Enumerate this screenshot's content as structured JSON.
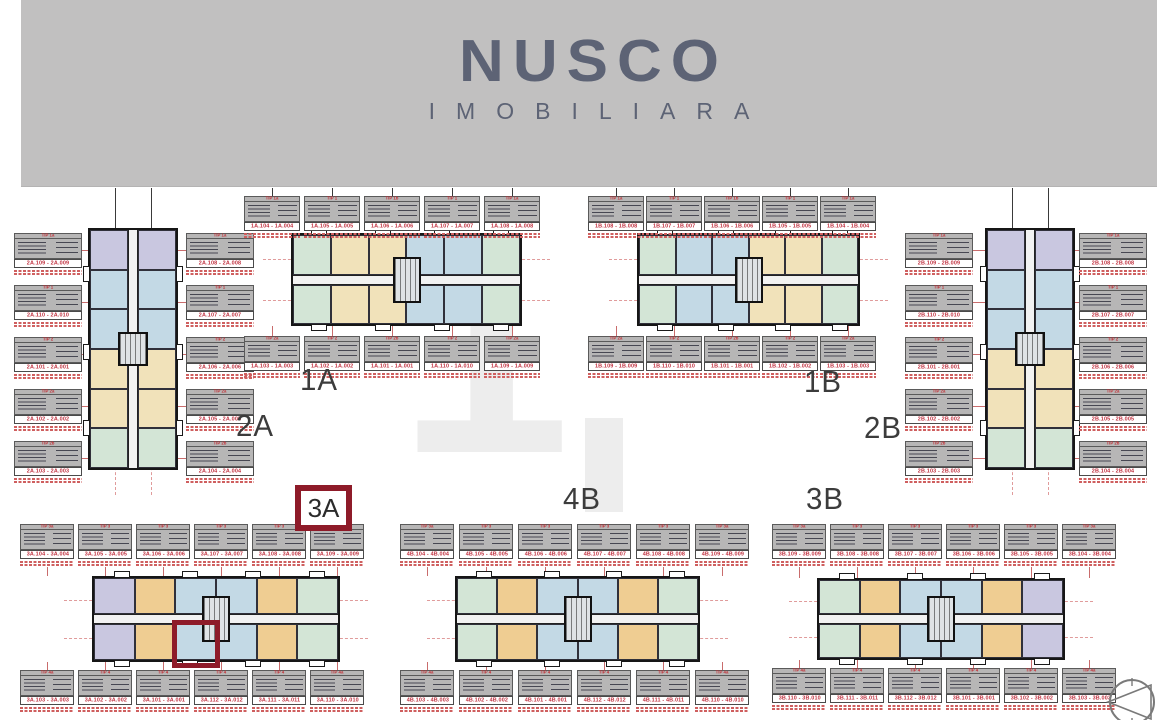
{
  "banner": {
    "logo_title": "NUSCO",
    "logo_subtitle": "IMOBILIARA"
  },
  "highlight": {
    "boxed_label": "3A"
  },
  "palette": {
    "accent_red": "#8e1b29",
    "card_red": "#c0303f",
    "banner_gray": "#c1c0c0",
    "logo_color": "#5d6375",
    "unit_blue": "#c3d9e5",
    "unit_green": "#d3e5d6",
    "unit_cream": "#f1e2ba",
    "unit_orange": "#efcd92",
    "unit_lavender": "#c9c7e0"
  },
  "icons": {
    "compass": "north-compass"
  },
  "buildings": [
    {
      "id": "2A",
      "label": "2A",
      "sections": [
        "lavender",
        "blue",
        "blue",
        "cream",
        "cream",
        "green"
      ],
      "cards_left": [
        {
          "tip": "TIP 1a",
          "range": "2A.109 - 2A.009"
        },
        {
          "tip": "TIP 1",
          "range": "2A.110 - 2A.010"
        },
        {
          "tip": "TIP 2",
          "range": "2A.101 - 2A.001"
        },
        {
          "tip": "TIP 2a",
          "range": "2A.102 - 2A.002"
        },
        {
          "tip": "TIP 2b",
          "range": "2A.103 - 2A.003"
        }
      ],
      "cards_right": [
        {
          "tip": "TIP 1a",
          "range": "2A.108 - 2A.008"
        },
        {
          "tip": "TIP 1",
          "range": "2A.107 - 2A.007"
        },
        {
          "tip": "TIP 2",
          "range": "2A.106 - 2A.006"
        },
        {
          "tip": "TIP 2a",
          "range": "2A.105 - 2A.005"
        },
        {
          "tip": "TIP 2b",
          "range": "2A.104 - 2A.004"
        }
      ]
    },
    {
      "id": "1A",
      "label": "1A",
      "sections": [
        "green",
        "cream",
        "cream",
        "blue",
        "blue",
        "green"
      ],
      "cards_top": [
        {
          "tip": "TIP 1a",
          "range": "1A.104 - 1A.004"
        },
        {
          "tip": "TIP 1",
          "range": "1A.105 - 1A.005"
        },
        {
          "tip": "TIP 1b",
          "range": "1A.106 - 1A.006"
        },
        {
          "tip": "TIP 1",
          "range": "1A.107 - 1A.007"
        },
        {
          "tip": "TIP 1a",
          "range": "1A.108 - 1A.008"
        }
      ],
      "cards_bottom": [
        {
          "tip": "TIP 2a",
          "range": "1A.103 - 1A.003"
        },
        {
          "tip": "TIP 2",
          "range": "1A.102 - 1A.002"
        },
        {
          "tip": "TIP 2b",
          "range": "1A.101 - 1A.001"
        },
        {
          "tip": "TIP 2",
          "range": "1A.110 - 1A.010"
        },
        {
          "tip": "TIP 2a",
          "range": "1A.109 - 1A.009"
        }
      ]
    },
    {
      "id": "1B",
      "label": "1B",
      "sections": [
        "green",
        "blue",
        "blue",
        "cream",
        "cream",
        "green"
      ],
      "cards_top": [
        {
          "tip": "TIP 1a",
          "range": "1B.108 - 1B.008"
        },
        {
          "tip": "TIP 1",
          "range": "1B.107 - 1B.007"
        },
        {
          "tip": "TIP 1b",
          "range": "1B.106 - 1B.006"
        },
        {
          "tip": "TIP 1",
          "range": "1B.105 - 1B.005"
        },
        {
          "tip": "TIP 1a",
          "range": "1B.104 - 1B.004"
        }
      ],
      "cards_bottom": [
        {
          "tip": "TIP 2a",
          "range": "1B.109 - 1B.009"
        },
        {
          "tip": "TIP 2",
          "range": "1B.110 - 1B.010"
        },
        {
          "tip": "TIP 2b",
          "range": "1B.101 - 1B.001"
        },
        {
          "tip": "TIP 2",
          "range": "1B.102 - 1B.002"
        },
        {
          "tip": "TIP 2a",
          "range": "1B.103 - 1B.003"
        }
      ]
    },
    {
      "id": "2B",
      "label": "2B",
      "sections": [
        "lavender",
        "blue",
        "blue",
        "cream",
        "cream",
        "green"
      ],
      "cards_left": [
        {
          "tip": "TIP 1a",
          "range": "2B.109 - 2B.009"
        },
        {
          "tip": "TIP 1",
          "range": "2B.110 - 2B.010"
        },
        {
          "tip": "TIP 2",
          "range": "2B.101 - 2B.001"
        },
        {
          "tip": "TIP 2a",
          "range": "2B.102 - 2B.002"
        },
        {
          "tip": "TIP 2b",
          "range": "2B.103 - 2B.003"
        }
      ],
      "cards_right": [
        {
          "tip": "TIP 1a",
          "range": "2B.108 - 2B.008"
        },
        {
          "tip": "TIP 1",
          "range": "2B.107 - 2B.007"
        },
        {
          "tip": "TIP 2",
          "range": "2B.106 - 2B.006"
        },
        {
          "tip": "TIP 2a",
          "range": "2B.105 - 2B.005"
        },
        {
          "tip": "TIP 2b",
          "range": "2B.104 - 2B.004"
        }
      ]
    },
    {
      "id": "3A",
      "label": "3A",
      "sections": [
        "lavender",
        "orange",
        "blue",
        "blue",
        "orange",
        "green"
      ],
      "cards_top": [
        {
          "tip": "TIP 3a",
          "range": "3A.104 - 3A.004"
        },
        {
          "tip": "TIP 3",
          "range": "3A.105 - 3A.005"
        },
        {
          "tip": "TIP 3",
          "range": "3A.106 - 3A.006"
        },
        {
          "tip": "TIP 3",
          "range": "3A.107 - 3A.007"
        },
        {
          "tip": "TIP 3",
          "range": "3A.108 - 3A.008"
        },
        {
          "tip": "TIP 3a",
          "range": "3A.109 - 3A.009"
        }
      ],
      "cards_bottom": [
        {
          "tip": "TIP 4a",
          "range": "3A.103 - 3A.003"
        },
        {
          "tip": "TIP 4",
          "range": "3A.102 - 3A.002"
        },
        {
          "tip": "TIP 4",
          "range": "3A.101 - 3A.001"
        },
        {
          "tip": "TIP 4",
          "range": "3A.112 - 3A.012"
        },
        {
          "tip": "TIP 4",
          "range": "3A.111 - 3A.011"
        },
        {
          "tip": "TIP 4a",
          "range": "3A.110 - 3A.010"
        }
      ]
    },
    {
      "id": "4B",
      "label": "4B",
      "sections": [
        "green",
        "orange",
        "blue",
        "blue",
        "orange",
        "green"
      ],
      "cards_top": [
        {
          "tip": "TIP 3a",
          "range": "4B.104 - 4B.004"
        },
        {
          "tip": "TIP 3",
          "range": "4B.105 - 4B.005"
        },
        {
          "tip": "TIP 3",
          "range": "4B.106 - 4B.006"
        },
        {
          "tip": "TIP 3",
          "range": "4B.107 - 4B.007"
        },
        {
          "tip": "TIP 3",
          "range": "4B.108 - 4B.008"
        },
        {
          "tip": "TIP 3a",
          "range": "4B.109 - 4B.009"
        }
      ],
      "cards_bottom": [
        {
          "tip": "TIP 4a",
          "range": "4B.103 - 4B.003"
        },
        {
          "tip": "TIP 4",
          "range": "4B.102 - 4B.002"
        },
        {
          "tip": "TIP 4",
          "range": "4B.101 - 4B.001"
        },
        {
          "tip": "TIP 4",
          "range": "4B.112 - 4B.012"
        },
        {
          "tip": "TIP 4",
          "range": "4B.111 - 4B.011"
        },
        {
          "tip": "TIP 4a",
          "range": "4B.110 - 4B.010"
        }
      ]
    },
    {
      "id": "3B",
      "label": "3B",
      "sections": [
        "green",
        "orange",
        "blue",
        "blue",
        "orange",
        "lavender"
      ],
      "cards_top": [
        {
          "tip": "TIP 3a",
          "range": "3B.109 - 3B.009"
        },
        {
          "tip": "TIP 3",
          "range": "3B.108 - 3B.008"
        },
        {
          "tip": "TIP 3",
          "range": "3B.107 - 3B.007"
        },
        {
          "tip": "TIP 3",
          "range": "3B.106 - 3B.006"
        },
        {
          "tip": "TIP 3",
          "range": "3B.105 - 3B.005"
        },
        {
          "tip": "TIP 3a",
          "range": "3B.104 - 3B.004"
        }
      ],
      "cards_bottom": [
        {
          "tip": "TIP 4a",
          "range": "3B.110 - 3B.010"
        },
        {
          "tip": "TIP 4",
          "range": "3B.111 - 3B.011"
        },
        {
          "tip": "TIP 4",
          "range": "3B.112 - 3B.012"
        },
        {
          "tip": "TIP 4",
          "range": "3B.101 - 3B.001"
        },
        {
          "tip": "TIP 4",
          "range": "3B.102 - 3B.002"
        },
        {
          "tip": "TIP 4a",
          "range": "3B.103 - 3B.003"
        }
      ]
    }
  ]
}
